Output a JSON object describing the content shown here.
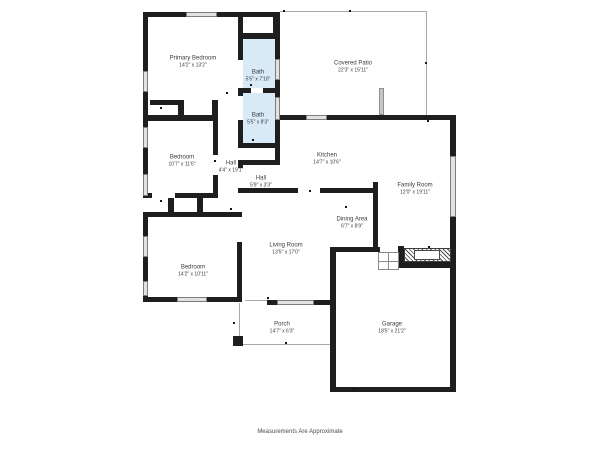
{
  "footer": "Measurements Are Approximate",
  "colors": {
    "wall": "#1e1e1e",
    "window": "#e2e2e2",
    "thin": "#a8a8a8",
    "bath": "#d7eaf6",
    "text": "#3b3b3b"
  },
  "rooms": {
    "primary_bedroom": {
      "name": "Primary Bedroom",
      "dims": "14'2\" x 13'2\""
    },
    "bath_upper": {
      "name": "Bath",
      "dims": "5'5\" x 7'10\""
    },
    "covered_patio": {
      "name": "Covered Patio",
      "dims": "22'3\" x 15'11\""
    },
    "bath_lower": {
      "name": "Bath",
      "dims": "5'5\" x 8'3\""
    },
    "bedroom_middle": {
      "name": "Bedroom",
      "dims": "10'7\" x 11'6\""
    },
    "hall_long": {
      "name": "Hall",
      "dims": "4'4\" x 19'1\""
    },
    "hall_short": {
      "name": "Hall",
      "dims": "5'9\" x 3'3\""
    },
    "kitchen": {
      "name": "Kitchen",
      "dims": "14'7\" x 10'6\""
    },
    "family_room": {
      "name": "Family Room",
      "dims": "12'0\" x 19'11\""
    },
    "dining_area": {
      "name": "Dining Area",
      "dims": "6'7\" x 8'9\""
    },
    "living_room": {
      "name": "Living Room",
      "dims": "13'5\" x 17'0\""
    },
    "bedroom_lower": {
      "name": "Bedroom",
      "dims": "14'2\" x 10'11\""
    },
    "porch": {
      "name": "Porch",
      "dims": "14'7\" x 6'3\""
    },
    "garage": {
      "name": "Garage",
      "dims": "18'5\" x 21'2\""
    }
  }
}
